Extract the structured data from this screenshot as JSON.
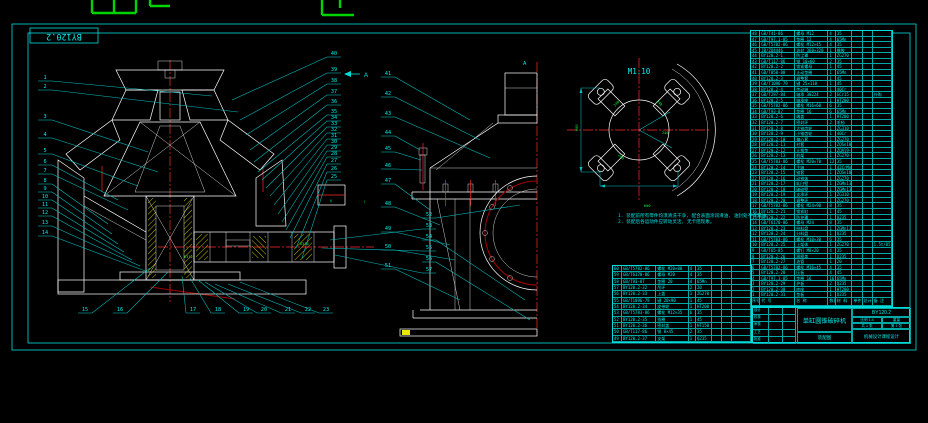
{
  "frame": {
    "corner_label": "BY120.2"
  },
  "colors": {
    "background": "#000000",
    "line_cyan": "#00dcdc",
    "line_white": "#ffffff",
    "hatch_yellow": "#ffff00",
    "centerline_red": "#ff2a2a",
    "flange_maroon": "#a00000",
    "tag_green": "#00ff33"
  },
  "views": {
    "section_arrow_label": "A",
    "elevation_label": "A",
    "spider": {
      "scale_label": "M1:10",
      "dim_width": "600",
      "dim_height": "600",
      "dim_note": "600",
      "arm_tags": [
        "240",
        "240",
        "240",
        "240"
      ]
    },
    "detail_tag": "Ⅱ",
    "bearing_tag_1": "6312",
    "bearing_tag_2": "6310",
    "between_tag": "Ⅰ"
  },
  "notes": [
    "1. 装配前所有零件均须清洗干净, 配合表面涂润滑油, 油封处不得漏油。",
    "2. 装配后各运动件应转动灵活, 无卡阻现象。"
  ],
  "balloons": {
    "left": [
      [
        1,
        44,
        79,
        212,
        96
      ],
      [
        2,
        44,
        88,
        238,
        112
      ],
      [
        3,
        44,
        118,
        148,
        152
      ],
      [
        4,
        44,
        136,
        158,
        172
      ],
      [
        5,
        44,
        152,
        138,
        186
      ],
      [
        6,
        44,
        163,
        118,
        200
      ],
      [
        7,
        44,
        172,
        128,
        210
      ],
      [
        8,
        44,
        182,
        108,
        224
      ],
      [
        9,
        44,
        190,
        112,
        234
      ],
      [
        10,
        44,
        198,
        118,
        244
      ],
      [
        11,
        44,
        206,
        124,
        252
      ],
      [
        12,
        44,
        214,
        132,
        260
      ],
      [
        13,
        44,
        224,
        140,
        266
      ],
      [
        14,
        44,
        234,
        148,
        272
      ]
    ],
    "bottom": [
      [
        15,
        84,
        311,
        150,
        268
      ],
      [
        16,
        119,
        311,
        168,
        272
      ],
      [
        17,
        192,
        311,
        182,
        276
      ],
      [
        18,
        217,
        311,
        190,
        278
      ],
      [
        19,
        245,
        311,
        198,
        280
      ],
      [
        20,
        263,
        311,
        205,
        282
      ],
      [
        21,
        287,
        311,
        215,
        284
      ],
      [
        22,
        307,
        311,
        228,
        284
      ],
      [
        23,
        325,
        311,
        240,
        282
      ]
    ],
    "right": [
      [
        40,
        333,
        55,
        232,
        100
      ],
      [
        39,
        333,
        71,
        240,
        120
      ],
      [
        38,
        333,
        82,
        246,
        135
      ],
      [
        37,
        333,
        93,
        250,
        150
      ],
      [
        36,
        333,
        103,
        254,
        162
      ],
      [
        35,
        333,
        113,
        258,
        172
      ],
      [
        34,
        333,
        119,
        262,
        180
      ],
      [
        33,
        333,
        125,
        266,
        188
      ],
      [
        32,
        333,
        131,
        270,
        196
      ],
      [
        31,
        333,
        137,
        274,
        205
      ],
      [
        30,
        333,
        143,
        278,
        214
      ],
      [
        29,
        333,
        149,
        282,
        222
      ],
      [
        28,
        333,
        155,
        286,
        230
      ],
      [
        27,
        333,
        162,
        290,
        238
      ],
      [
        26,
        333,
        170,
        296,
        248
      ],
      [
        25,
        333,
        178,
        302,
        258
      ]
    ],
    "mid": [
      [
        41,
        387,
        75,
        470,
        120
      ],
      [
        42,
        387,
        95,
        480,
        140
      ],
      [
        43,
        387,
        115,
        490,
        158
      ],
      [
        44,
        387,
        134,
        420,
        150
      ],
      [
        45,
        387,
        150,
        421,
        160
      ],
      [
        46,
        387,
        167,
        422,
        170
      ],
      [
        47,
        387,
        182,
        430,
        210
      ],
      [
        48,
        387,
        205,
        440,
        225
      ],
      [
        49,
        387,
        230,
        450,
        245
      ],
      [
        50,
        387,
        248,
        455,
        260
      ],
      [
        51,
        387,
        267,
        460,
        300
      ]
    ],
    "stack": [
      [
        52,
        428,
        216,
        520,
        205
      ],
      [
        53,
        428,
        227,
        330,
        240
      ],
      [
        54,
        428,
        238,
        525,
        300
      ],
      [
        55,
        428,
        249,
        322,
        248
      ],
      [
        56,
        428,
        260,
        530,
        320
      ],
      [
        57,
        428,
        271,
        335,
        255
      ]
    ]
  },
  "bom_right": {
    "widths": [
      10,
      38,
      36,
      8,
      18,
      11,
      11,
      21
    ],
    "rows": [
      [
        "48",
        "GB/T41-86",
        "螺母 M12",
        "4",
        "35",
        "",
        "",
        ""
      ],
      [
        "47",
        "GB/T97.1-85",
        "垫圈 12",
        "4",
        "65Mn",
        "",
        "",
        ""
      ],
      [
        "46",
        "GB/T5782-86",
        "螺栓 M12×45",
        "4",
        "35",
        "",
        "",
        ""
      ],
      [
        "45",
        "JB/ZQ4446",
        "油封 360×320",
        "1",
        "橡胶",
        "",
        "",
        ""
      ],
      [
        "44",
        "BY120.2-1",
        "防尘罩",
        "1",
        "ZG270",
        "",
        "",
        ""
      ],
      [
        "43",
        "GB/T117-86",
        "销 10×60",
        "2",
        "35",
        "",
        "",
        ""
      ],
      [
        "42",
        "BY120.2-2",
        "锁紧螺母",
        "1",
        "45",
        "",
        "",
        ""
      ],
      [
        "41",
        "GB/T858-88",
        "止动垫圈",
        "1",
        "65Mn",
        "",
        "",
        ""
      ],
      [
        "40",
        "BY120.2-3",
        "调整套",
        "1",
        "45",
        "",
        "",
        ""
      ],
      [
        "39",
        "GB/T1096-79",
        "键 25×110",
        "1",
        "45",
        "",
        "",
        ""
      ],
      [
        "38",
        "BY120.2-4",
        "传动轴",
        "1",
        "40Cr",
        "",
        "",
        ""
      ],
      [
        "37",
        "GB/T297-84",
        "轴承 30224",
        "2",
        "GCr15",
        "",
        "",
        "外购"
      ],
      [
        "36",
        "BY120.2-5",
        "轴承座",
        "1",
        "HT200",
        "",
        "",
        ""
      ],
      [
        "35",
        "GB/T5782-86",
        "螺栓 M16×60",
        "6",
        "35",
        "",
        "",
        ""
      ],
      [
        "34",
        "GB/T93-87",
        "垫圈 16",
        "6",
        "65Mn",
        "",
        "",
        ""
      ],
      [
        "33",
        "BY120.2-6",
        "端盖",
        "1",
        "HT200",
        "",
        "",
        ""
      ],
      [
        "32",
        "BY120.2-7",
        "密封环",
        "2",
        "毛毡",
        "",
        "",
        ""
      ],
      [
        "31",
        "BY120.2-8",
        "大锥齿轮",
        "1",
        "ZG310",
        "",
        "",
        ""
      ],
      [
        "30",
        "BY120.2-9",
        "小锥齿轮",
        "1",
        "40Cr",
        "",
        "",
        ""
      ],
      [
        "29",
        "BY120.2-10",
        "偏心套",
        "1",
        "ZG270",
        "",
        "",
        ""
      ],
      [
        "28",
        "BY120.2-11",
        "衬套",
        "1",
        "ZQSn10",
        "",
        "",
        ""
      ],
      [
        "27",
        "BY120.2-12",
        "止推垫",
        "1",
        "ZQAl9-4",
        "",
        "",
        ""
      ],
      [
        "26",
        "BY120.2-13",
        "机架",
        "1",
        "ZG270-500",
        "",
        "",
        ""
      ],
      [
        "25",
        "GB/T5783-86",
        "螺栓 M20×70",
        "12",
        "35",
        "",
        "",
        ""
      ],
      [
        "24",
        "BY120.2-14",
        "主轴",
        "1",
        "42CrMo",
        "",
        "",
        ""
      ],
      [
        "23",
        "BY120.2-15",
        "锥套",
        "1",
        "ZQSn10-1",
        "",
        "",
        ""
      ],
      [
        "22",
        "BY120.2-16",
        "动锥体",
        "1",
        "ZG270",
        "",
        "",
        ""
      ],
      [
        "21",
        "BY120.2-17",
        "轧臼壁",
        "1",
        "ZGMn13",
        "",
        "",
        ""
      ],
      [
        "20",
        "BY120.2-18",
        "破碎壁",
        "1",
        "ZGMn13",
        "",
        "",
        ""
      ],
      [
        "19",
        "BY120.2-19",
        "支承环",
        "1",
        "ZG310",
        "",
        "",
        ""
      ],
      [
        "18",
        "BY120.2-20",
        "调整环",
        "1",
        "ZG270",
        "",
        "",
        ""
      ],
      [
        "17",
        "GB/T5782-86",
        "螺栓 M24×90",
        "8",
        "35",
        "",
        "",
        ""
      ],
      [
        "16",
        "BY120.2-21",
        "锁紧缸",
        "1",
        "45",
        "",
        "",
        ""
      ],
      [
        "15",
        "BY120.2-22",
        "防护罩",
        "1",
        "Q235",
        "",
        "",
        ""
      ],
      [
        "14",
        "GB/T6170-86",
        "螺母 M24",
        "8",
        "35",
        "",
        "",
        ""
      ],
      [
        "13",
        "BY120.2-23",
        "给料盘",
        "1",
        "ZGMn13",
        "",
        "",
        ""
      ],
      [
        "12",
        "BY120.2-24",
        "分料盘",
        "1",
        "Q235",
        "",
        "",
        ""
      ],
      [
        "11",
        "GB/T5783-86",
        "螺栓 M10×30",
        "6",
        "35",
        "",
        "",
        ""
      ],
      [
        "10",
        "BY120.2-25",
        "上架体",
        "1",
        "ZG270",
        "",
        "",
        "1.5t/05"
      ],
      [
        "9",
        "GB/T65-85",
        "螺钉 M8×20",
        "4",
        "35",
        "",
        "",
        ""
      ],
      [
        "8",
        "BY120.2-26",
        "观察盖",
        "1",
        "Q235",
        "",
        "",
        ""
      ],
      [
        "7",
        "BY120.2-27",
        "油管",
        "1",
        "20",
        "",
        "",
        ""
      ],
      [
        "6",
        "GB/T5782-86",
        "螺栓 M16×45",
        "4",
        "35",
        "",
        "",
        ""
      ],
      [
        "5",
        "BY120.2-28",
        "压板",
        "4",
        "45",
        "",
        "",
        ""
      ],
      [
        "4",
        "GB/T97.1-85",
        "垫圈 16",
        "16",
        "65Mn",
        "",
        "",
        ""
      ],
      [
        "3",
        "BY120.2-29",
        "护板",
        "2",
        "Q235",
        "",
        "",
        ""
      ],
      [
        "2",
        "BY120.2-30",
        "底座",
        "1",
        "HT200",
        "",
        "",
        ""
      ],
      [
        "1",
        "BY120.2-31",
        "垫板",
        "1",
        "Q235",
        "",
        "",
        ""
      ],
      [
        "序号",
        "代 号",
        "名 称",
        "数量",
        "材 料",
        "单件",
        "总计",
        "备 注"
      ]
    ]
  },
  "bom_mid": {
    "widths": [
      10,
      38,
      36,
      8,
      18,
      11,
      11,
      21
    ],
    "rows": [
      [
        "60",
        "GB/T5782-86",
        "螺栓 M20×80",
        "4",
        "35",
        "",
        "",
        ""
      ],
      [
        "59",
        "GB/T6170-86",
        "螺母 M20",
        "4",
        "35",
        "",
        "",
        ""
      ],
      [
        "58",
        "GB/T93-87",
        "垫圈 20",
        "4",
        "65Mn",
        "",
        "",
        ""
      ],
      [
        "57",
        "BY120.2-32",
        "吊环",
        "2",
        "20",
        "",
        "",
        ""
      ],
      [
        "56",
        "BY120.2-33",
        "上盖",
        "1",
        "ZG270",
        "",
        "",
        ""
      ],
      [
        "55",
        "GB/T1096-79",
        "键 20×90",
        "1",
        "45",
        "",
        "",
        ""
      ],
      [
        "54",
        "BY120.2-34",
        "皮带轮",
        "1",
        "HT200",
        "",
        "",
        ""
      ],
      [
        "53",
        "GB/T5783-86",
        "螺栓 M12×35",
        "6",
        "35",
        "",
        "",
        ""
      ],
      [
        "52",
        "BY120.2-35",
        "挡圈",
        "1",
        "45",
        "",
        "",
        ""
      ],
      [
        "51",
        "BY120.2-36",
        "密封盖",
        "1",
        "HT150",
        "",
        "",
        ""
      ],
      [
        "50",
        "GB/T117-86",
        "销 8×45",
        "2",
        "35",
        "",
        "",
        ""
      ],
      [
        "49",
        "BY120.2-37",
        "支架",
        "1",
        "Q235",
        "",
        "",
        ""
      ]
    ]
  },
  "title_block": {
    "sig_cells": [
      "设计",
      "",
      "",
      "校核",
      "",
      "",
      "审核",
      "",
      "",
      "工艺",
      "",
      "",
      "批准",
      "",
      ""
    ],
    "title": "单缸圆锥破碎机",
    "subtitle": "装配图",
    "drawing_no": "BY120.2",
    "scale_label": "比例 1:4",
    "weight_label": "重量",
    "sheet_label": "共 1 张",
    "sheet_label2": "第 1 张",
    "institution": "机械设计课程设计"
  }
}
